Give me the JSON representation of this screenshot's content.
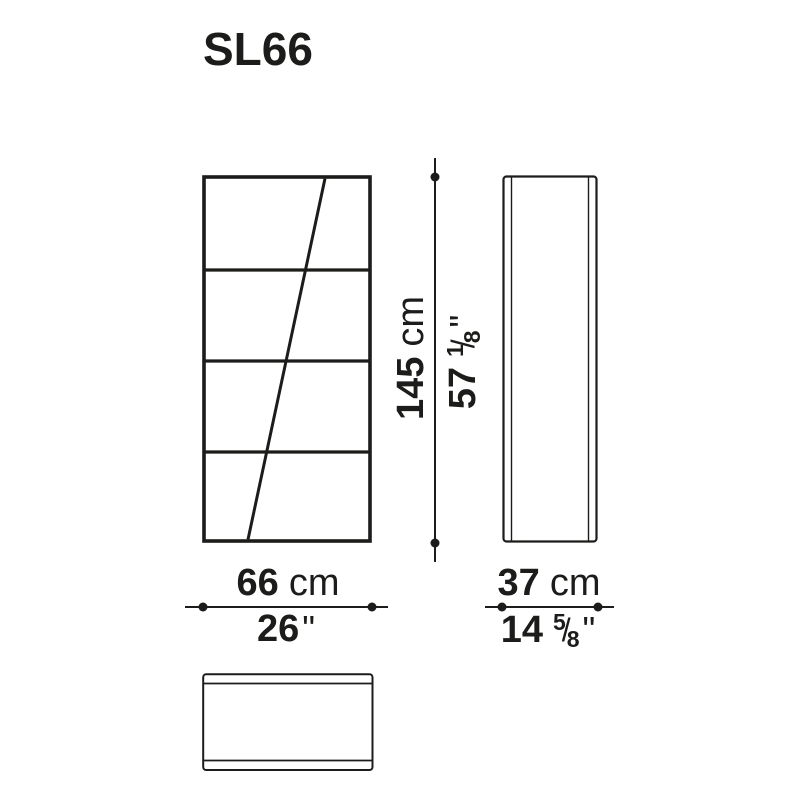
{
  "title": "SL66",
  "colors": {
    "ink": "#1c1c1a",
    "background": "#ffffff"
  },
  "dimensions": {
    "height": {
      "metric_value": "145",
      "metric_unit": "cm",
      "imperial_whole": "57",
      "fraction_numerator": "1",
      "fraction_slash": "/",
      "fraction_denominator": "8",
      "inch_mark": "\""
    },
    "width": {
      "metric_value": "66",
      "metric_unit": "cm",
      "imperial_whole": "26",
      "inch_mark": "\""
    },
    "depth": {
      "metric_value": "37",
      "metric_unit": "cm",
      "imperial_whole": "14",
      "fraction_numerator": "5",
      "fraction_slash": "/",
      "fraction_denominator": "8",
      "inch_mark": "\""
    }
  }
}
